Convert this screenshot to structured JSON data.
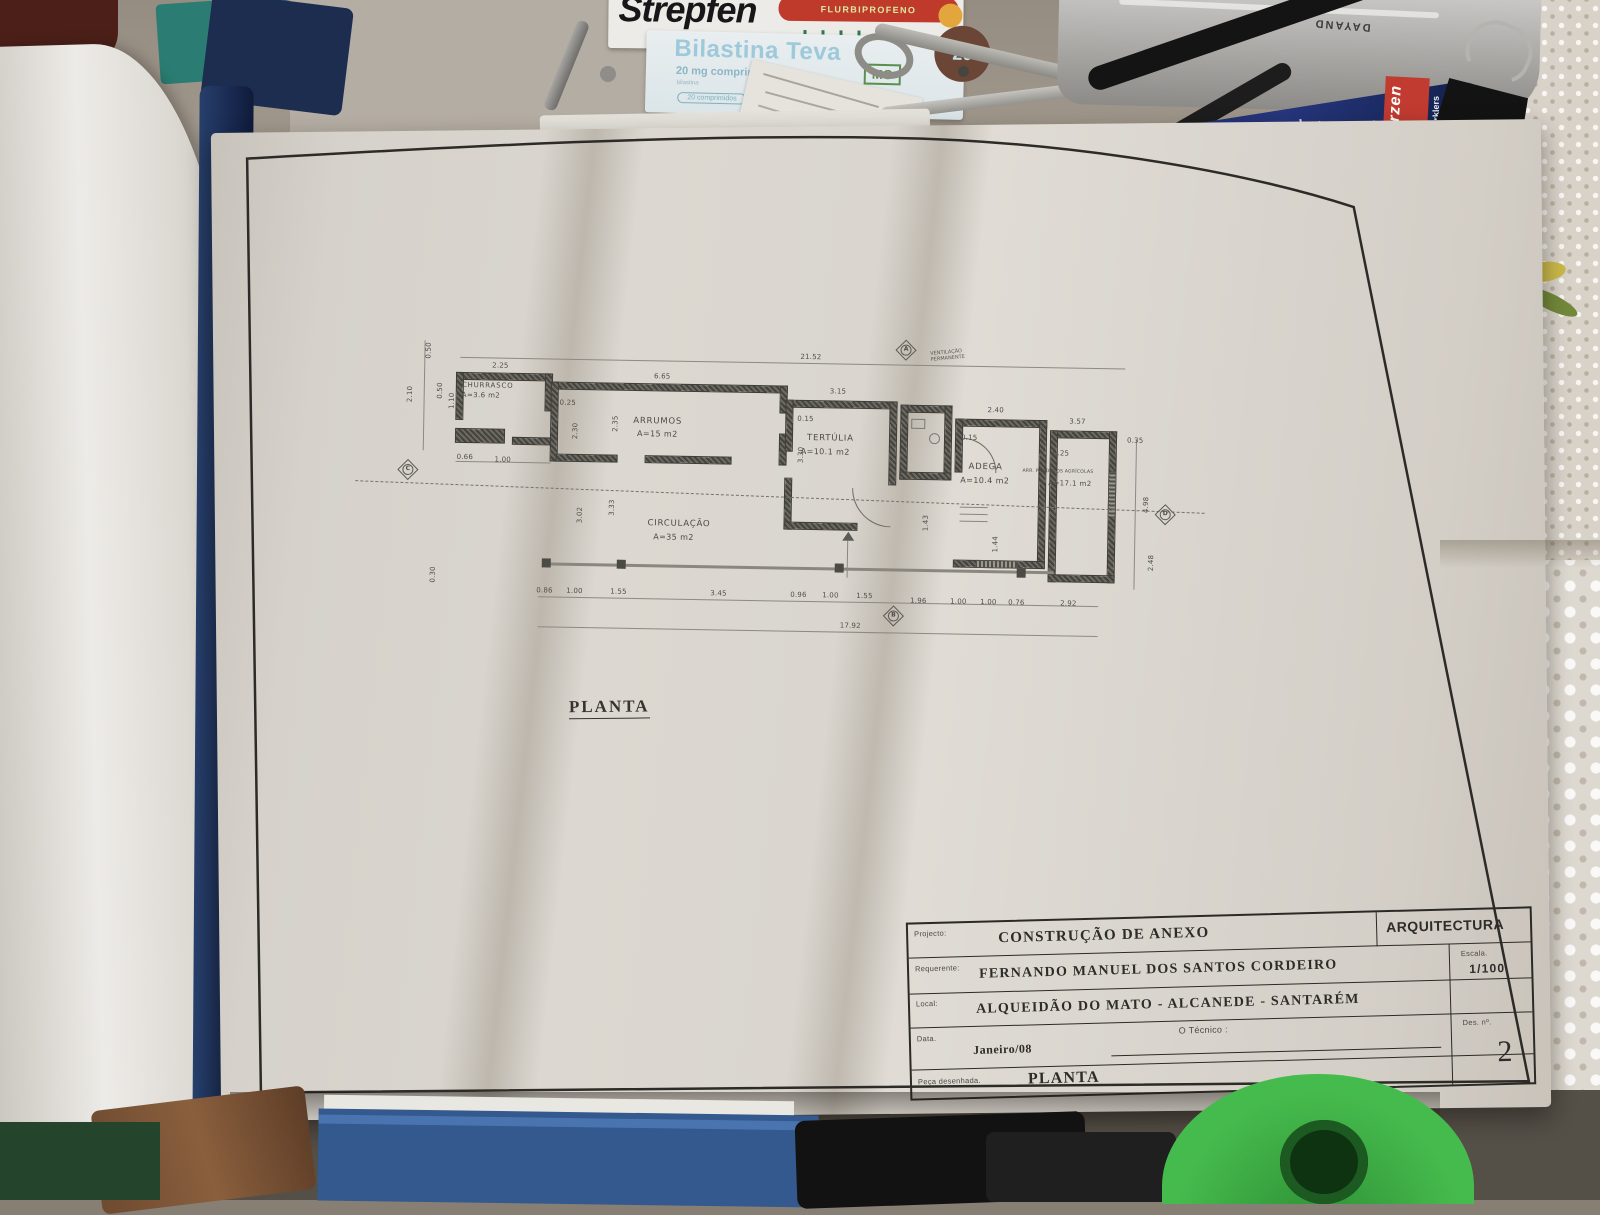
{
  "scene": {
    "strepfen": {
      "brand": "Strepfen",
      "band": "FLURBIPROFENO"
    },
    "bilastina": {
      "brand": "Bilastina Teva",
      "dose": "20 mg comprimidos",
      "sub": "bilastina",
      "logo": "MG",
      "count": "20 comprimidos",
      "badge": "20"
    },
    "sparklers": {
      "brand": "Wunderkerzen",
      "line1": "Electric Sparklers",
      "line2": "Julgransbloss",
      "line3": "Cierges Magiques"
    },
    "tool": {
      "brand": "DAYAND"
    }
  },
  "drawing": {
    "label": "PLANTA",
    "note_line1": "VENTILAÇÃO",
    "note_line2": "PERMANENTE",
    "markers": {
      "a": "A",
      "b": "B",
      "c": "C",
      "d": "D"
    },
    "rooms": [
      {
        "name": "CHURRASCO",
        "area": "A=3.6 m2"
      },
      {
        "name": "ARRUMOS",
        "area": "A=15 m2"
      },
      {
        "name": "TERTÚLIA",
        "area": "A=10.1 m2"
      },
      {
        "name": "ADEGA",
        "area": "A=10.4 m2"
      },
      {
        "name": "ARR. PRODUTOS AGRÍCOLAS",
        "area": "A=17.1 m2"
      },
      {
        "name": "CIRCULAÇÃO",
        "area": "A=35 m2"
      }
    ],
    "dims": {
      "top_total": "21.52",
      "bottom_total": "17.92",
      "churrasco_w": "2.25",
      "arrumos_w": "6.65",
      "tertulia_w": "3.15",
      "adega_w": "2.40",
      "arrprod_w": "3.57",
      "w025a": "0.25",
      "w015a": "0.15",
      "w015b": "0.15",
      "w025b": "0.25",
      "w035": "0.35",
      "left_050a": "0.50",
      "left_210": "2.10",
      "left_050b": "0.50",
      "left_110": "1.10",
      "left_066": "0.66",
      "left_100": "1.00",
      "left_030": "0.30",
      "v302": "3.02",
      "v333": "3.33",
      "v230": "2.30",
      "v235": "2.35",
      "v330": "3.30",
      "v143": "1.43",
      "v144": "1.44",
      "right_498": "4.98",
      "right_248": "2.48",
      "bottom": [
        "0.86",
        "1.00",
        "1.55",
        "3.45",
        "0.96",
        "1.00",
        "1.55",
        "1.96",
        "1.00",
        "1.00",
        "0.76",
        "2.92"
      ]
    },
    "title_block": {
      "project_label": "Projecto:",
      "project": "CONSTRUÇÃO DE ANEXO",
      "discipline": "ARQUITECTURA",
      "client_label": "Requerente:",
      "client": "FERNANDO MANUEL DOS SANTOS CORDEIRO",
      "scale_label": "Escala.",
      "scale": "1/100",
      "location_label": "Local:",
      "location": "ALQUEIDÃO DO MATO - ALCANEDE - SANTARÉM",
      "date_label": "Data.",
      "date": "Janeiro/08",
      "technician_label": "O Técnico :",
      "number_label": "Des. nº.",
      "number": "2",
      "piece_label": "Peça desenhada.",
      "piece": "PLANTA"
    }
  }
}
